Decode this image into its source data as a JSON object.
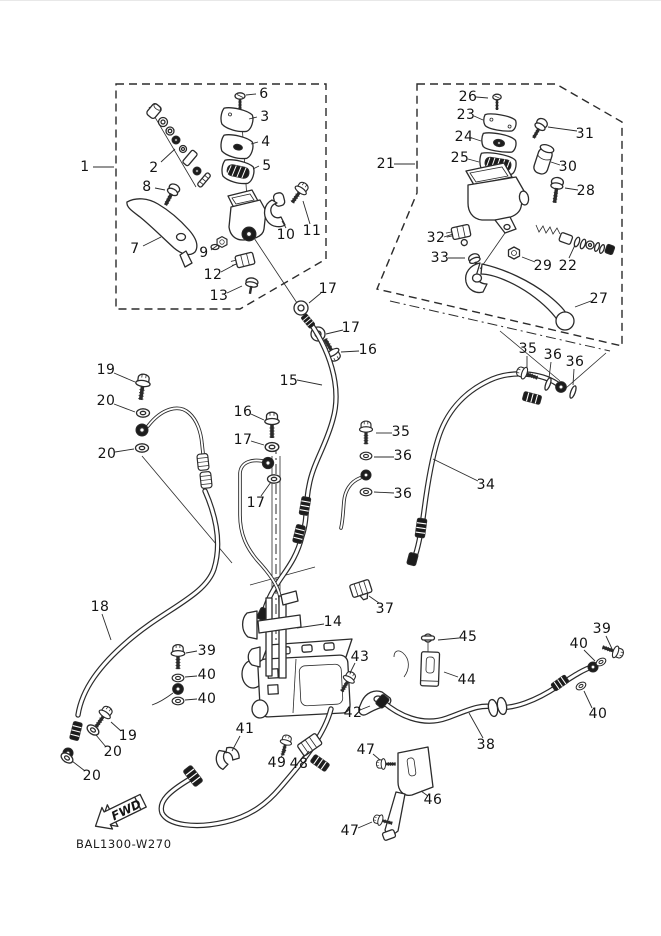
{
  "diagram": {
    "code": "BAL1300-W270",
    "fwd_label": "FWD",
    "colors": {
      "line": "#2b2b2b",
      "label": "#141414",
      "background": "#ffffff"
    },
    "part_labels": [
      {
        "t": "1",
        "x": 85,
        "y": 166,
        "l": [
          93,
          166,
          114,
          166
        ]
      },
      {
        "t": "2",
        "x": 154,
        "y": 167,
        "l": [
          161,
          161,
          175,
          148
        ]
      },
      {
        "t": "3",
        "x": 265,
        "y": 116,
        "l": [
          257,
          116,
          249,
          118
        ]
      },
      {
        "t": "4",
        "x": 266,
        "y": 141,
        "l": [
          258,
          141,
          251,
          143
        ]
      },
      {
        "t": "5",
        "x": 267,
        "y": 165,
        "l": [
          259,
          165,
          253,
          168
        ]
      },
      {
        "t": "6",
        "x": 264,
        "y": 93,
        "l": [
          256,
          93,
          246,
          94
        ]
      },
      {
        "t": "7",
        "x": 135,
        "y": 248,
        "l": [
          143,
          245,
          161,
          236
        ]
      },
      {
        "t": "8",
        "x": 147,
        "y": 186,
        "l": [
          155,
          187,
          165,
          189
        ]
      },
      {
        "t": "9",
        "x": 204,
        "y": 252,
        "l": [
          211,
          249,
          218,
          244
        ]
      },
      {
        "t": "10",
        "x": 286,
        "y": 234,
        "l": [
          286,
          227,
          282,
          220
        ]
      },
      {
        "t": "11",
        "x": 312,
        "y": 230,
        "l": [
          310,
          223,
          303,
          200
        ]
      },
      {
        "t": "12",
        "x": 213,
        "y": 274,
        "l": [
          221,
          271,
          236,
          263
        ]
      },
      {
        "t": "13",
        "x": 219,
        "y": 295,
        "l": [
          227,
          292,
          242,
          285
        ]
      },
      {
        "t": "14",
        "x": 333,
        "y": 621,
        "l": [
          324,
          623,
          297,
          627
        ]
      },
      {
        "t": "15",
        "x": 289,
        "y": 380,
        "l": [
          297,
          379,
          322,
          384
        ]
      },
      {
        "t": "16",
        "x": 368,
        "y": 349,
        "l": [
          359,
          350,
          341,
          351
        ]
      },
      {
        "t": "16",
        "x": 243,
        "y": 411,
        "l": [
          251,
          413,
          264,
          419
        ]
      },
      {
        "t": "17",
        "x": 328,
        "y": 288,
        "l": [
          321,
          292,
          309,
          302
        ]
      },
      {
        "t": "17",
        "x": 351,
        "y": 327,
        "l": [
          343,
          329,
          326,
          333
        ]
      },
      {
        "t": "17",
        "x": 243,
        "y": 439,
        "l": [
          251,
          440,
          264,
          444
        ]
      },
      {
        "t": "17",
        "x": 256,
        "y": 502,
        "l": [
          261,
          495,
          271,
          481
        ]
      },
      {
        "t": "18",
        "x": 100,
        "y": 606,
        "l": [
          102,
          613,
          111,
          639
        ]
      },
      {
        "t": "19",
        "x": 106,
        "y": 369,
        "l": [
          114,
          372,
          135,
          381
        ]
      },
      {
        "t": "19",
        "x": 128,
        "y": 735,
        "l": [
          121,
          730,
          111,
          721
        ]
      },
      {
        "t": "20",
        "x": 106,
        "y": 400,
        "l": [
          114,
          403,
          135,
          411
        ]
      },
      {
        "t": "20",
        "x": 107,
        "y": 453,
        "l": [
          115,
          451,
          134,
          448
        ]
      },
      {
        "t": "20",
        "x": 113,
        "y": 751,
        "l": [
          106,
          746,
          96,
          734
        ]
      },
      {
        "t": "20",
        "x": 92,
        "y": 775,
        "l": [
          85,
          770,
          72,
          760
        ]
      },
      {
        "t": "21",
        "x": 386,
        "y": 163,
        "l": [
          394,
          163,
          415,
          163
        ]
      },
      {
        "t": "22",
        "x": 568,
        "y": 265,
        "l": [
          569,
          257,
          575,
          244
        ]
      },
      {
        "t": "23",
        "x": 466,
        "y": 114,
        "l": [
          474,
          115,
          483,
          119
        ]
      },
      {
        "t": "24",
        "x": 464,
        "y": 136,
        "l": [
          472,
          137,
          481,
          140
        ]
      },
      {
        "t": "25",
        "x": 460,
        "y": 157,
        "l": [
          468,
          158,
          479,
          161
        ]
      },
      {
        "t": "26",
        "x": 468,
        "y": 96,
        "l": [
          476,
          96,
          488,
          97
        ]
      },
      {
        "t": "27",
        "x": 599,
        "y": 298,
        "l": [
          591,
          300,
          575,
          306
        ]
      },
      {
        "t": "28",
        "x": 586,
        "y": 190,
        "l": [
          578,
          189,
          565,
          187
        ]
      },
      {
        "t": "29",
        "x": 543,
        "y": 265,
        "l": [
          535,
          261,
          522,
          256
        ]
      },
      {
        "t": "30",
        "x": 568,
        "y": 166,
        "l": [
          560,
          164,
          551,
          161
        ]
      },
      {
        "t": "31",
        "x": 585,
        "y": 133,
        "l": [
          577,
          130,
          548,
          126
        ]
      },
      {
        "t": "32",
        "x": 436,
        "y": 237,
        "l": [
          444,
          236,
          453,
          233
        ]
      },
      {
        "t": "33",
        "x": 440,
        "y": 257,
        "l": [
          448,
          257,
          465,
          257
        ]
      },
      {
        "t": "34",
        "x": 486,
        "y": 484,
        "l": [
          478,
          480,
          433,
          458
        ]
      },
      {
        "t": "35",
        "x": 528,
        "y": 348,
        "l": [
          527,
          355,
          527,
          367
        ]
      },
      {
        "t": "35",
        "x": 401,
        "y": 431,
        "l": [
          392,
          432,
          376,
          432
        ]
      },
      {
        "t": "36",
        "x": 553,
        "y": 354,
        "l": [
          551,
          361,
          549,
          377
        ]
      },
      {
        "t": "36",
        "x": 575,
        "y": 361,
        "l": [
          574,
          368,
          573,
          384
        ]
      },
      {
        "t": "36",
        "x": 403,
        "y": 455,
        "l": [
          394,
          456,
          374,
          456
        ]
      },
      {
        "t": "36",
        "x": 403,
        "y": 493,
        "l": [
          394,
          492,
          374,
          491
        ]
      },
      {
        "t": "37",
        "x": 385,
        "y": 608,
        "l": [
          379,
          602,
          369,
          595
        ]
      },
      {
        "t": "38",
        "x": 486,
        "y": 744,
        "l": [
          483,
          737,
          469,
          712
        ]
      },
      {
        "t": "39",
        "x": 207,
        "y": 650,
        "l": [
          197,
          650,
          186,
          652
        ]
      },
      {
        "t": "39",
        "x": 602,
        "y": 628,
        "l": [
          606,
          635,
          613,
          650
        ]
      },
      {
        "t": "40",
        "x": 207,
        "y": 674,
        "l": [
          197,
          675,
          185,
          676
        ]
      },
      {
        "t": "40",
        "x": 207,
        "y": 698,
        "l": [
          197,
          698,
          185,
          699
        ]
      },
      {
        "t": "40",
        "x": 579,
        "y": 643,
        "l": [
          584,
          649,
          595,
          660
        ]
      },
      {
        "t": "40",
        "x": 598,
        "y": 713,
        "l": [
          592,
          707,
          584,
          690
        ]
      },
      {
        "t": "41",
        "x": 245,
        "y": 728,
        "l": [
          240,
          735,
          232,
          750
        ]
      },
      {
        "t": "42",
        "x": 353,
        "y": 712,
        "l": [
          360,
          709,
          370,
          705
        ]
      },
      {
        "t": "43",
        "x": 360,
        "y": 656,
        "l": [
          355,
          662,
          350,
          672
        ]
      },
      {
        "t": "44",
        "x": 467,
        "y": 679,
        "l": [
          458,
          676,
          444,
          671
        ]
      },
      {
        "t": "45",
        "x": 468,
        "y": 636,
        "l": [
          459,
          637,
          438,
          639
        ]
      },
      {
        "t": "46",
        "x": 433,
        "y": 799,
        "l": [
          428,
          795,
          421,
          790
        ]
      },
      {
        "t": "47",
        "x": 366,
        "y": 749,
        "l": [
          373,
          753,
          380,
          759
        ]
      },
      {
        "t": "47",
        "x": 350,
        "y": 830,
        "l": [
          358,
          827,
          372,
          821
        ]
      },
      {
        "t": "48",
        "x": 299,
        "y": 763,
        "l": [
          303,
          757,
          309,
          750
        ]
      },
      {
        "t": "49",
        "x": 277,
        "y": 762,
        "l": [
          281,
          756,
          286,
          749
        ]
      }
    ]
  }
}
